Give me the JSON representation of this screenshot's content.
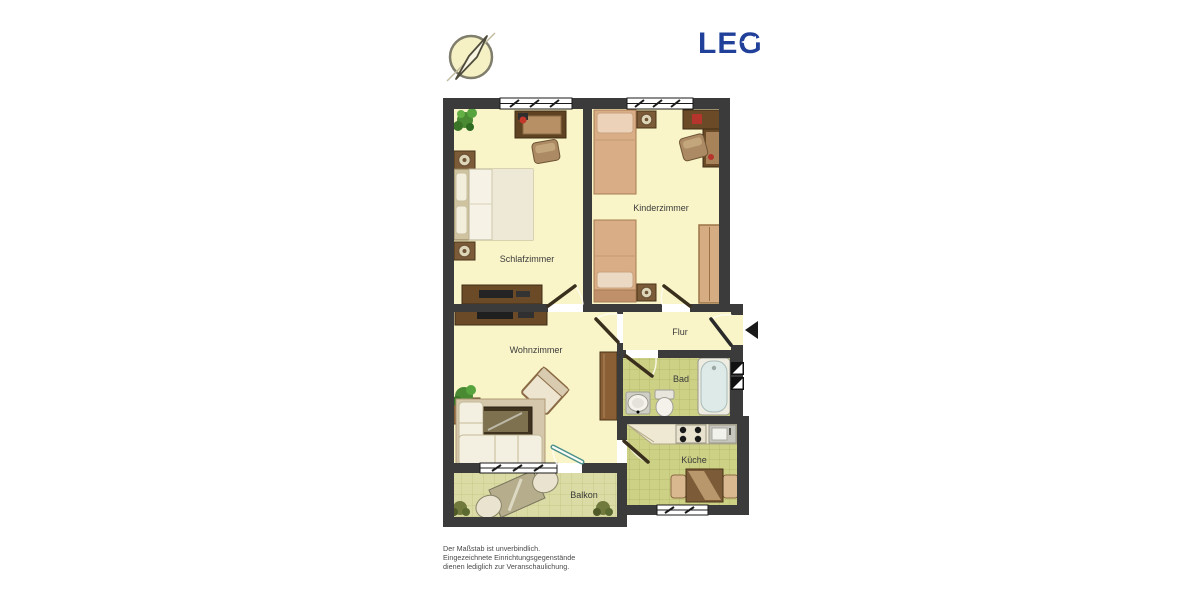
{
  "header": {
    "logo": {
      "text": "LEG",
      "color": "#21409a"
    },
    "compass_icon": "compass-north-indicator"
  },
  "floorplan": {
    "rooms": {
      "schlafzimmer": {
        "label": "Schlafzimmer"
      },
      "kinderzimmer": {
        "label": "Kinderzimmer"
      },
      "wohnzimmer": {
        "label": "Wohnzimmer"
      },
      "flur": {
        "label": "Flur"
      },
      "bad": {
        "label": "Bad"
      },
      "kueche": {
        "label": "Küche"
      },
      "balkon": {
        "label": "Balkon"
      }
    },
    "colors": {
      "wall": "#3c3b3b",
      "floor": "#f9f5c8",
      "tile_bath_kitchen": "#cdd186",
      "tile_balcony": "#dbdba6",
      "label_text": "#3b3b3b",
      "door_leaf": "#3a2f1d"
    }
  },
  "footer": {
    "disclaimer": [
      "Der Maßstab ist unverbindlich.",
      "Eingezeichnete Einrichtungsgegenstände",
      "dienen lediglich zur Veranschaulichung."
    ]
  }
}
